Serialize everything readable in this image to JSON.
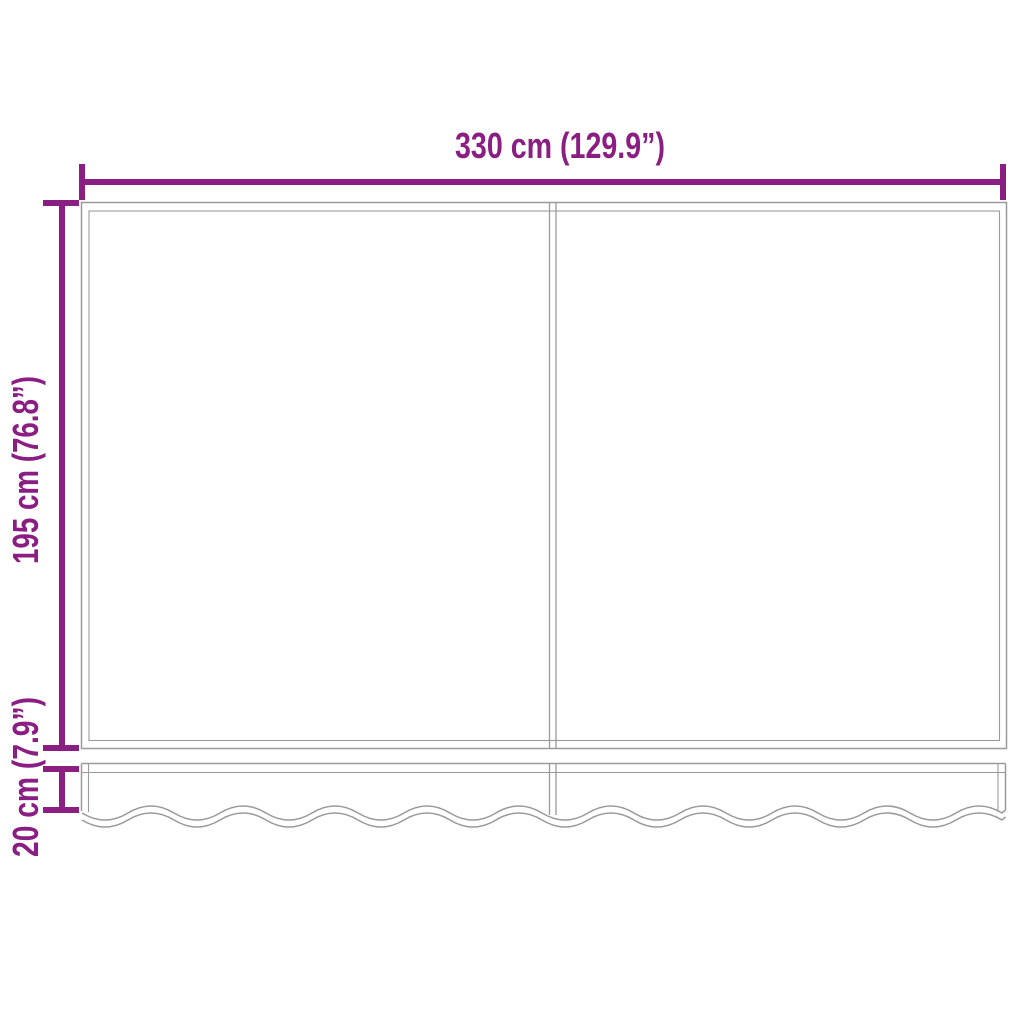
{
  "diagram": {
    "kind": "product-dimension-diagram",
    "labels": {
      "width": "330 cm (129.9”)",
      "height": "195 cm (76.8”)",
      "valance_height": "20 cm (7.9”)"
    },
    "colors": {
      "dimension": "#8A1E82",
      "outline": "#9A9A9A",
      "background": "#FFFFFF"
    }
  }
}
